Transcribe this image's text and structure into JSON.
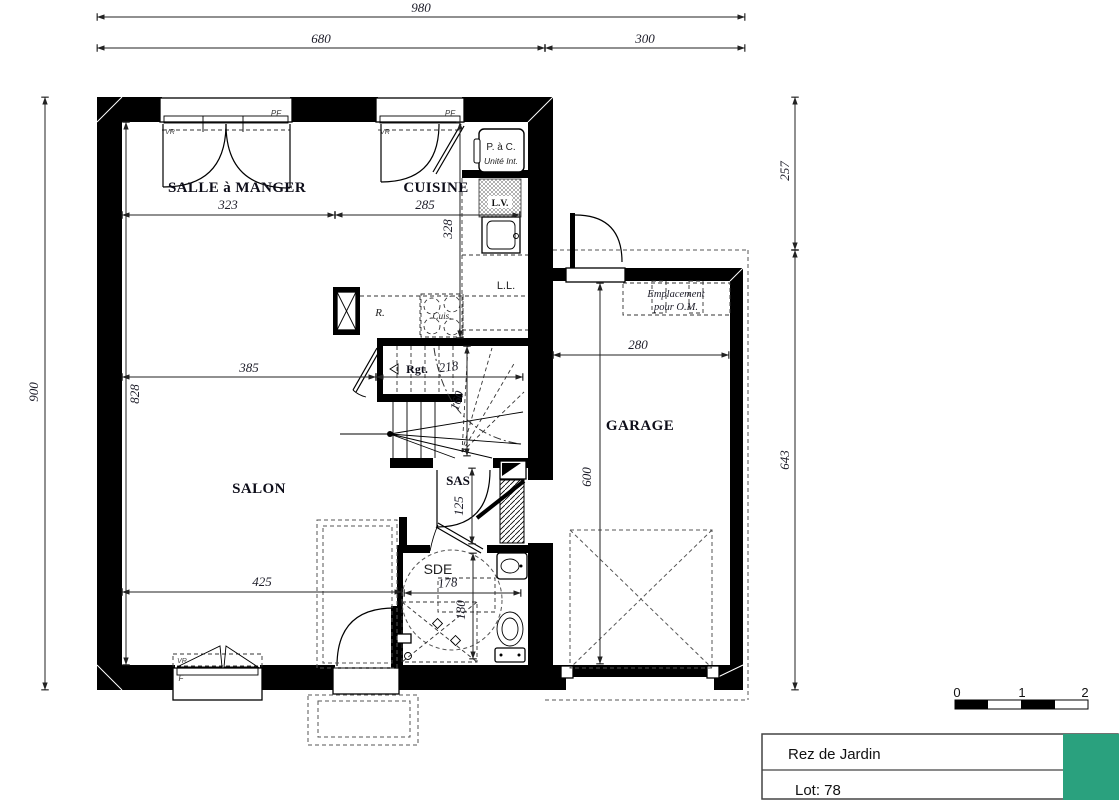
{
  "title_block": {
    "floor_name": "Rez de Jardin",
    "lot_label": "Lot: 78",
    "accent_color": "#2aa17e"
  },
  "scale_bar": {
    "tick0": "0",
    "tick1": "1",
    "tick2": "2"
  },
  "rooms": {
    "dining": "SALLE à MANGER",
    "kitchen": "CUISINE",
    "living": "SALON",
    "garage": "GARAGE",
    "sas": "SAS",
    "sde": "SDE",
    "storage": "Rgt."
  },
  "dimensions": {
    "overall_width": "980",
    "house_width": "680",
    "garage_width": "300",
    "overall_depth": "900",
    "interior_depth": "828",
    "right_top": "257",
    "right_bottom": "643",
    "dining_width": "323",
    "kitchen_width": "285",
    "kitchen_depth": "328",
    "living_width_mid": "385",
    "stair_width": "218",
    "stair_depth": "160",
    "living_width_low": "425",
    "sas_depth": "125",
    "sde_width": "178",
    "sde_depth": "180",
    "garage_inner_width": "280",
    "garage_inner_depth": "600"
  },
  "labels": {
    "pf_dining": "PF",
    "vr_dining": "VR",
    "pf_kitchen": "PF",
    "vr_kitchen": "VR",
    "window_living": "F",
    "vr_living": "VR",
    "heat_pump_line1": "P. à C.",
    "heat_pump_line2": "Unité Int.",
    "dishwasher": "L.V.",
    "washer": "L.L.",
    "fridge": "R.",
    "hob": "Cuis.",
    "om_line1": "Emplacement",
    "om_line2": "pour O.M."
  }
}
